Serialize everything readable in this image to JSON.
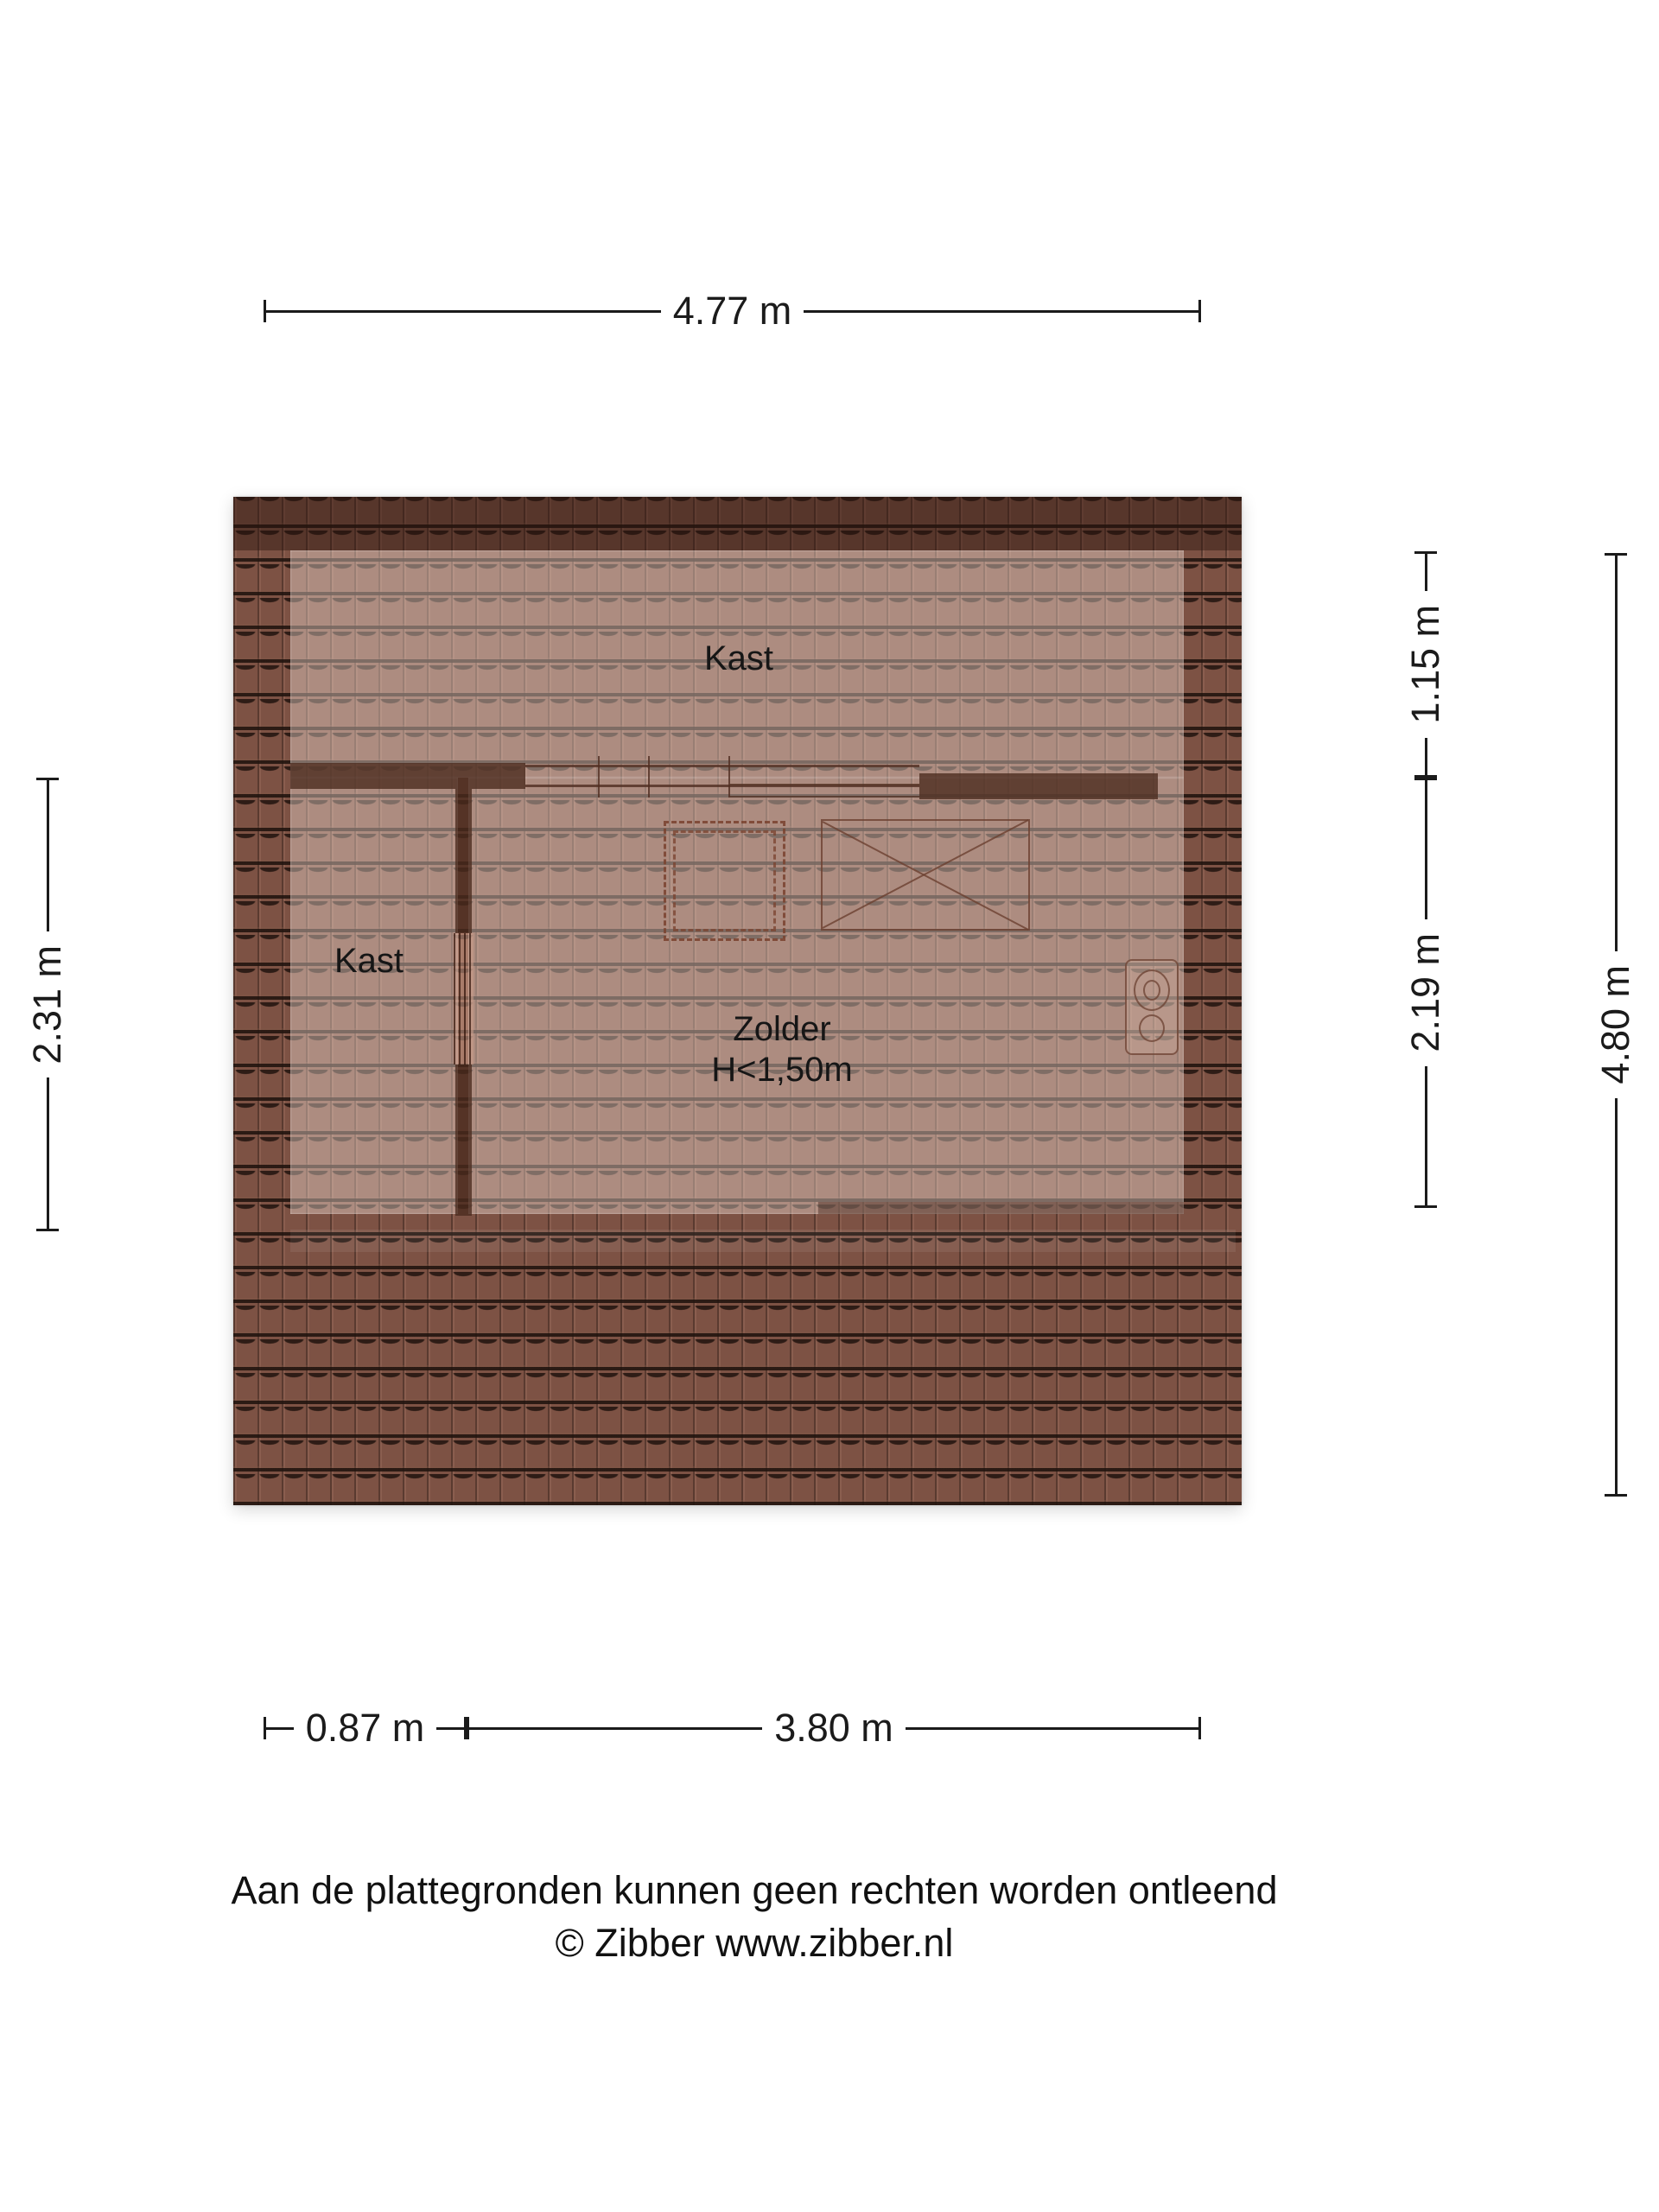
{
  "floorplan": {
    "title": "zolder-plattegrond",
    "colors": {
      "tile_base": "#7d5244",
      "room_light": "rgba(240,222,212,0.42)",
      "ridge_shade": "rgba(43,20,13,0.45)",
      "wall": "rgba(74,42,30,0.78)",
      "line_brown": "#6b4030",
      "dim_color": "#1b1b1b"
    },
    "rooms": [
      {
        "label": "Kast",
        "position": "top"
      },
      {
        "label": "Kast",
        "position": "left"
      },
      {
        "label": "Zolder",
        "height_note": "H<1,50m",
        "position": "center"
      }
    ],
    "symbols": [
      {
        "name": "stair-opening",
        "style": "double-dashed-rectangle"
      },
      {
        "name": "roof-window",
        "style": "crossed-rectangle"
      },
      {
        "name": "mechanical-unit",
        "style": "panel-with-two-circles"
      }
    ],
    "dimensions": {
      "top": "4.77 m",
      "left": "2.31 m",
      "right_inner_top": "1.15 m",
      "right_inner_bottom": "2.19 m",
      "right_outer": "4.80 m",
      "bottom_left": "0.87 m",
      "bottom_right": "3.80 m"
    },
    "footer": {
      "disclaimer": "Aan de plattegronden kunnen geen rechten worden ontleend",
      "credit": "© Zibber www.zibber.nl"
    }
  }
}
